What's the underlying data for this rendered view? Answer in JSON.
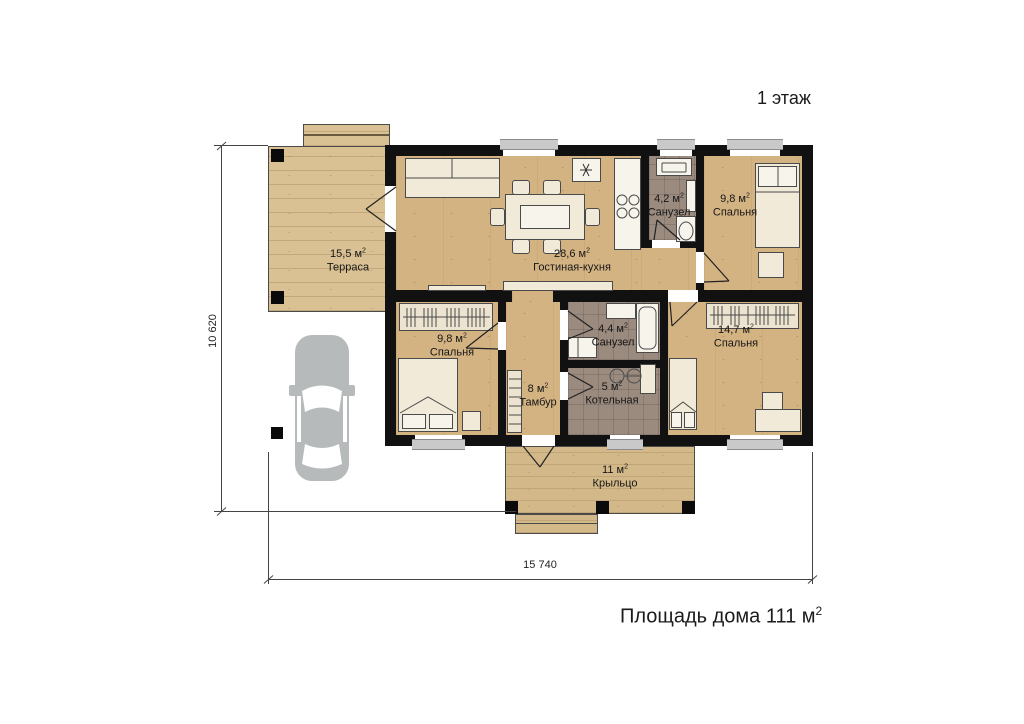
{
  "title": "1 этаж",
  "footer": {
    "text": "Площадь дома 111 м",
    "sup": "2"
  },
  "dims": {
    "height": "10 620",
    "width": "15 740"
  },
  "sup": "2",
  "rooms": [
    {
      "area": "15,5 м",
      "name": "Терраса"
    },
    {
      "area": "28,6 м",
      "name": "Гостиная-кухня"
    },
    {
      "area": "4,2 м",
      "name": "Санузел"
    },
    {
      "area": "9,8 м",
      "name": "Спальня"
    },
    {
      "area": "9,8 м",
      "name": "Спальня"
    },
    {
      "area": "8 м",
      "name": "Тамбур"
    },
    {
      "area": "4,4 м",
      "name": "Санузел"
    },
    {
      "area": "5 м",
      "name": "Котельная"
    },
    {
      "area": "14,7 м",
      "name": "Спальня"
    },
    {
      "area": "11 м",
      "name": "Крыльцо"
    }
  ],
  "icons": {
    "car": "car-top-view-silhouette"
  },
  "colors": {
    "wall": "#111111",
    "wood": "#d4b383",
    "terrace": "#d9c194",
    "porch": "#d3b989",
    "tile": "#9b8b7f",
    "sill": "#c9c9c9",
    "car": "#b7babb",
    "furniture": "#f1ead8"
  }
}
